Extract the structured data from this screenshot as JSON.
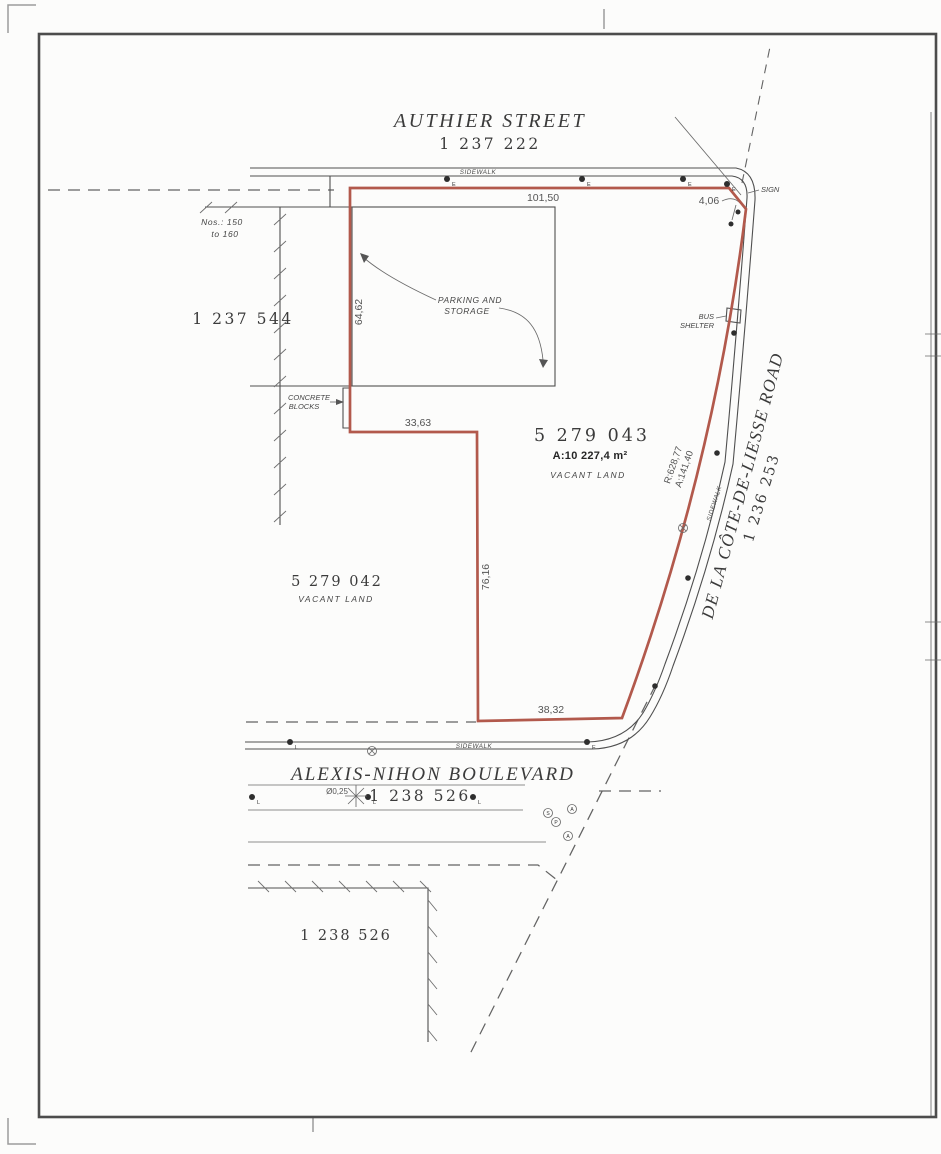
{
  "sheet": {
    "background": "#fcfcfb",
    "border_color": "#4c4c4c"
  },
  "colors": {
    "parcel_boundary": "#b2594c",
    "drawing_line": "#4f4f4f",
    "dimension_text": "#555555"
  },
  "streets": {
    "authier": {
      "name": "AUTHIER STREET",
      "lot_number": "1 237 222"
    },
    "cote_de_liesse": {
      "name": "DE LA CÔTE-DE-LIESSE ROAD",
      "lot_number": "1 236 253"
    },
    "alexis_nihon": {
      "name": "ALEXIS-NIHON BOULEVARD",
      "lot_number": "1 238 526"
    }
  },
  "parcels": {
    "subject": {
      "lot_number": "5 279 043",
      "area": "A:10 227,4 m²",
      "designation": "VACANT LAND"
    },
    "west": {
      "lot_number": "5 279 042",
      "designation": "VACANT LAND"
    },
    "northwest_building": {
      "lot_number": "1 237 544",
      "civic_line1": "Nos.: 150",
      "civic_line2": "to 160"
    },
    "south_building": {
      "lot_number": "1 238 526"
    }
  },
  "dimensions": {
    "north_side": "101,50",
    "corner_cut": "4,06",
    "west_side_upper": "64,62",
    "jog": "33,63",
    "west_side_lower": "76,16",
    "south_side": "38,32",
    "curve_radius": "R:628,77",
    "curve_arc": "A:141,40"
  },
  "labels": {
    "sidewalk": "SIDEWALK",
    "sign": "SIGN",
    "bus_shelter_line1": "BUS",
    "bus_shelter_line2": "SHELTER",
    "parking_line1": "PARKING AND",
    "parking_line2": "STORAGE",
    "concrete_line1": "CONCRETE",
    "concrete_line2": "BLOCKS",
    "tree_diameter": "Ø0,25"
  },
  "symbols": {
    "electric": "E",
    "lamp": "L",
    "s": "S",
    "p": "P",
    "a": "A"
  }
}
